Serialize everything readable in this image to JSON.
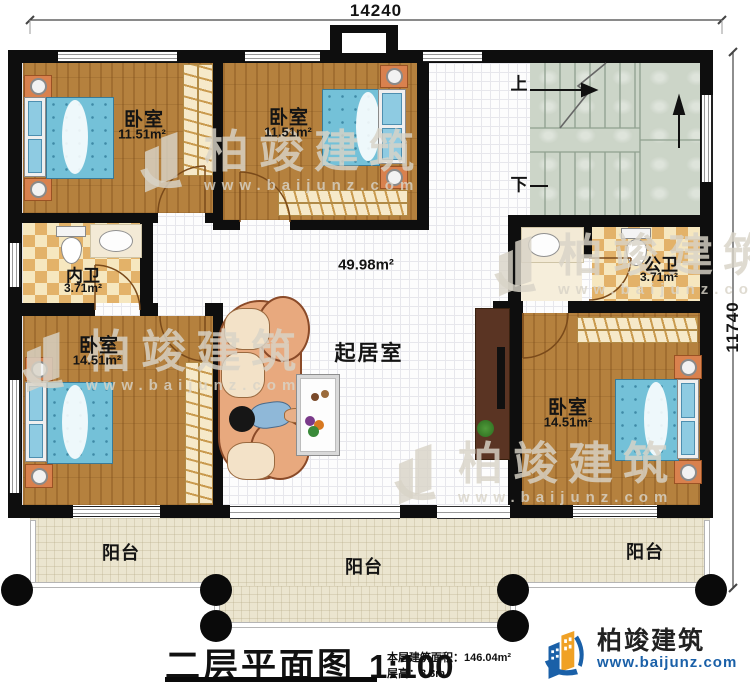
{
  "plan": {
    "dimension_top": "14240",
    "dimension_right": "11740",
    "rooms": {
      "bedroom_tl": {
        "name": "卧室",
        "area": "11.51m²"
      },
      "bedroom_tm": {
        "name": "卧室",
        "area": "11.51m²"
      },
      "bedroom_bl": {
        "name": "卧室",
        "area": "14.51m²"
      },
      "bedroom_br": {
        "name": "卧室",
        "area": "14.51m²"
      },
      "bath_inner": {
        "name": "内卫",
        "area": "3.71m²"
      },
      "bath_public": {
        "name": "公卫",
        "area": "3.71m²"
      },
      "living": {
        "name": "起居室",
        "area": "49.98m²"
      },
      "balcony_left": {
        "name": "阳台"
      },
      "balcony_center": {
        "name": "阳台"
      },
      "balcony_right": {
        "name": "阳台"
      }
    },
    "stairs": {
      "up_label": "上",
      "down_label": "下"
    }
  },
  "titleblock": {
    "title": "二层平面图",
    "scale": "1:100",
    "floor_area_label": "本层建筑面积：",
    "floor_area_value": "146.04m²",
    "floor_height_label": "层高：",
    "floor_height_value": "3.3m"
  },
  "brand": {
    "name": "柏竣建筑",
    "url": "www.baijunz.com"
  },
  "watermark": {
    "name": "柏竣建筑",
    "url": "www.baijunz.com"
  },
  "colors": {
    "wall": "#0e0e0e",
    "wood_floor": "#b5813e",
    "tile": "#e3b269",
    "hall": "#fdfdfd",
    "stairs": "#ccd5c8",
    "balcony": "#ebe5cf",
    "mattress": "#74c1d8",
    "sofa": "#e8a97e",
    "brand_blue": "#1a60a8",
    "brand_orange": "#f0a125"
  }
}
